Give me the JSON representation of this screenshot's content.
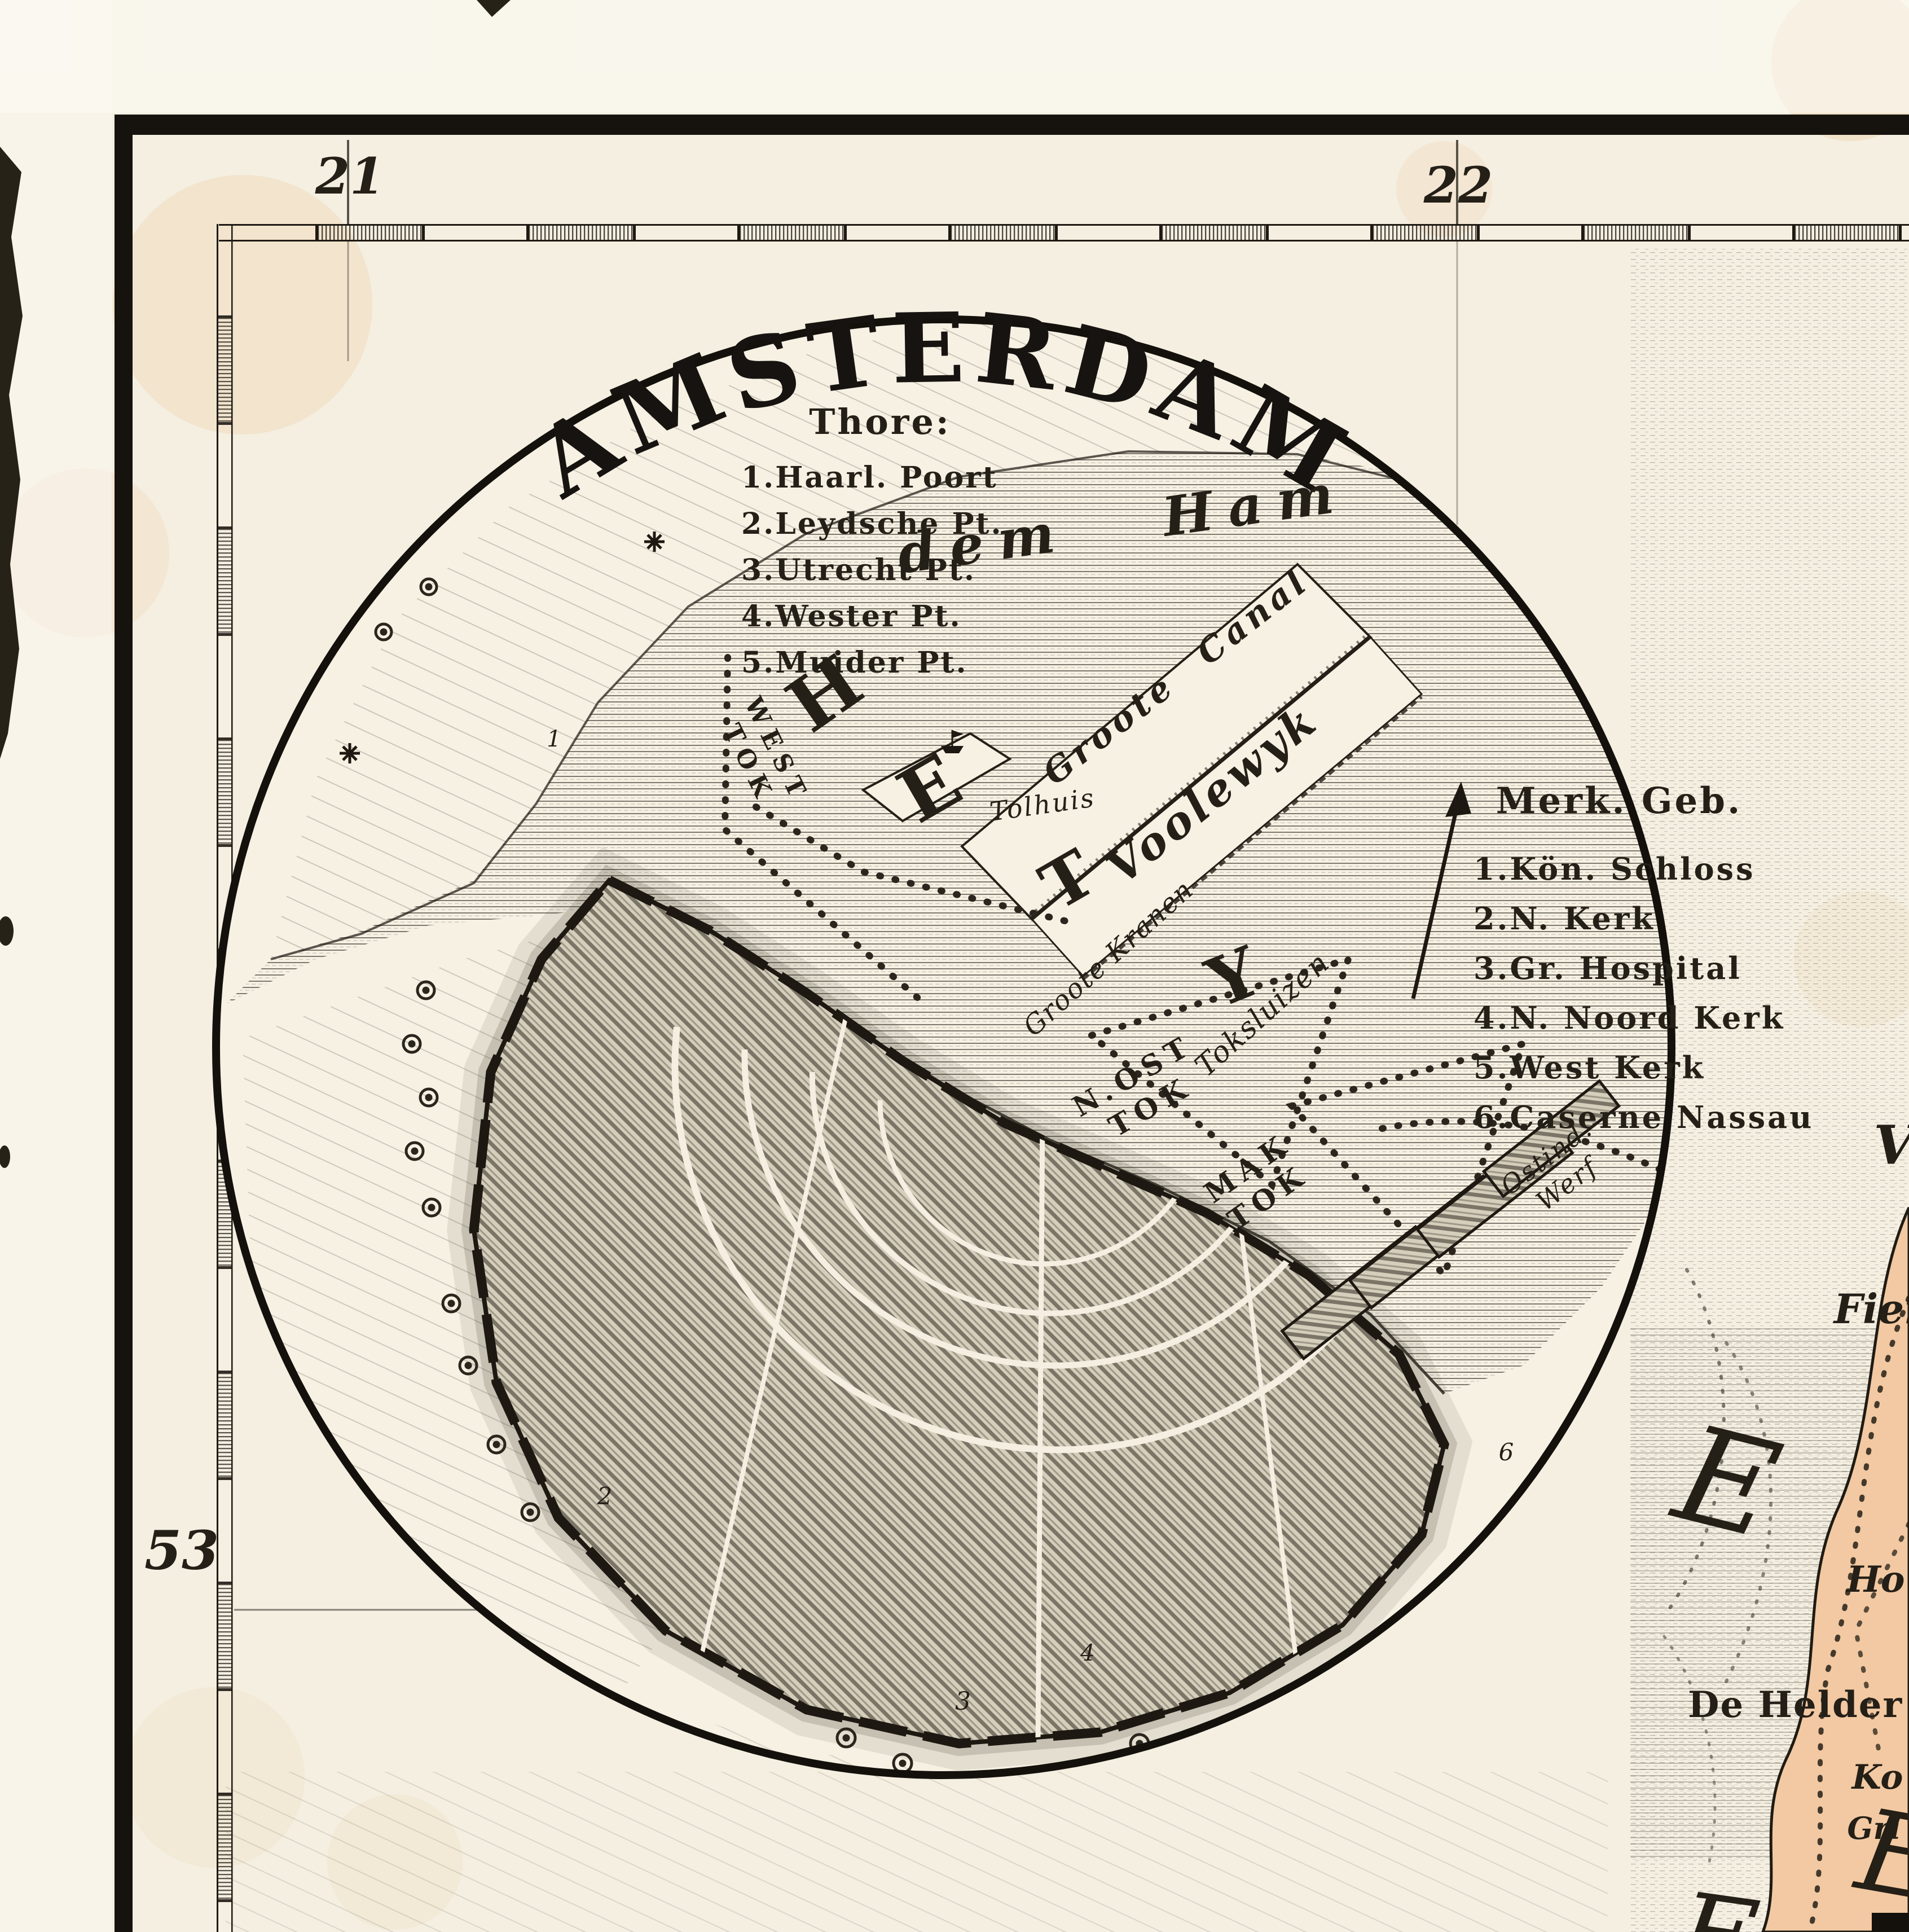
{
  "palette": {
    "paper": "#f4efe1",
    "ink": "#241f17",
    "land_tint": "#f2c9a2"
  },
  "graticule": {
    "lon_left": "21",
    "lon_right": "22",
    "lat_left": "53"
  },
  "inset": {
    "title": "AMSTERDAM",
    "gates": {
      "heading": "Thore:",
      "items": [
        "1.Haarl. Poort",
        "2.Leydsche Pt.",
        "3.Utrecht Pt.",
        "4.Wester Pt.",
        "5.Muider Pt."
      ]
    },
    "buildings": {
      "heading": "Merk. Geb.",
      "items": [
        "1.Kön. Schloss",
        "2.N. Kerk",
        "3.Gr. Hospital",
        "4.N. Noord Kerk",
        "5.West Kerk",
        "6.Caserne Nassau"
      ]
    },
    "water_labels": {
      "dem_ham": "dem Ham",
      "het": [
        "H",
        "E",
        "T",
        "Y"
      ],
      "groote_canal": "Groote Canal",
      "voolewyk": "Voolewyk",
      "tolhuis": "Tolhuis",
      "groote_kranen": "Groote Kranen",
      "toksluizen": "Toksluizen"
    },
    "harbors": {
      "west_tok": [
        "WEST",
        "TOK"
      ],
      "nost_tok": [
        "N.OST",
        "TOK"
      ],
      "mak_tok": [
        "MAK",
        "TOK"
      ],
      "ostind_werf": [
        "Ostind.",
        "Werf"
      ]
    },
    "markers": [
      "1",
      "2",
      "3",
      "4",
      "6"
    ]
  },
  "outer_map": {
    "fragments": {
      "v": "V",
      "fier": "Fier",
      "big_e_upper": "E",
      "ho": "Ho",
      "de_helder": "De Helder",
      "ko": "Ko",
      "gri": "Gri",
      "big_e_lower": "E",
      "big_e_bottom": "E"
    }
  }
}
